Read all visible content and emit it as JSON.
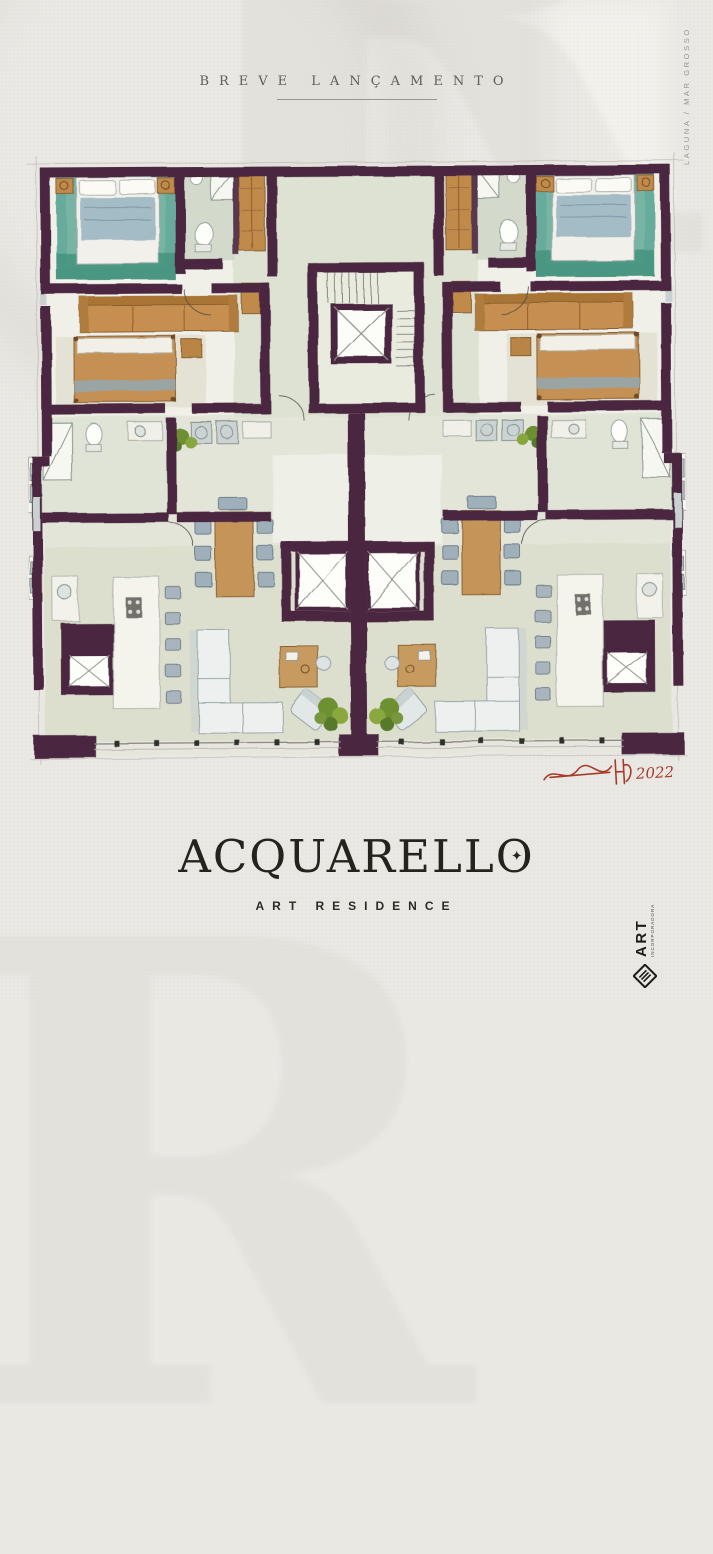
{
  "poster": {
    "announcement": "BREVE LANÇAMENTO",
    "location_note": "LAGUNA / MAR GROSSO",
    "wordmark": "ACQUARELLO",
    "wordmark_diamond": "✦",
    "tagline": "ART RESIDENCE",
    "signature_year": "2022",
    "watermark_letter": "R"
  },
  "developer_logo": {
    "name": "ART",
    "subtext": "INCORPORADORA",
    "icon": "diamond-monogram"
  },
  "floorplan": {
    "type": "watercolor-architectural-floor-plan",
    "units": 2,
    "layout": "mirrored apartments around central core",
    "features": [
      "master bedroom with teal rug (both corners, top)",
      "second bedroom with wood bed",
      "brown sofa and wardrobes",
      "bathrooms and laundry",
      "central stair core with elevator",
      "twin elevator shafts at lower core",
      "kitchen with island and bar stools",
      "dining table with six chairs",
      "L-shaped white sofa and armchair in living room",
      "plants at hallway and terrace",
      "balcony railing along bottom edge"
    ]
  },
  "colors": {
    "paper": "#eae8e3",
    "wall_plum": "#4b2741",
    "teal_rug": "#5ea797",
    "sage_floor": "#d9ddcb",
    "wood_tan": "#c28b4c",
    "slate_blue": "#a4bcc6",
    "plant_green": "#6d8f33",
    "signature_red": "#a63b2c",
    "ink": "#26231f"
  }
}
